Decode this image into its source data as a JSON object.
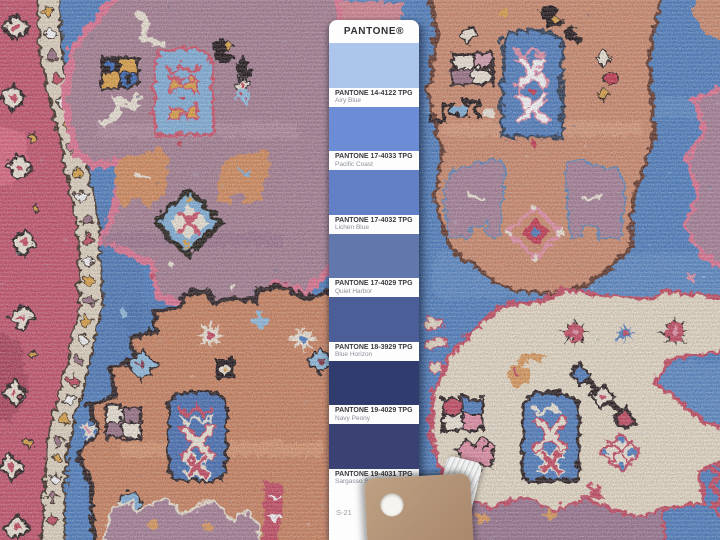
{
  "pantone_card": {
    "brand": "PANTONE®",
    "swatches": [
      {
        "code": "PANTONE 14-4122 TPG",
        "name": "Airy Blue",
        "hex": "#ACC5EA"
      },
      {
        "code": "PANTONE 17-4033 TPG",
        "name": "Pacific Coast",
        "hex": "#6C8DD6"
      },
      {
        "code": "PANTONE 17-4032 TPG",
        "name": "Lichen Blue",
        "hex": "#6380C6"
      },
      {
        "code": "PANTONE 17-4029 TPG",
        "name": "Quiet Harbor",
        "hex": "#6277AB"
      },
      {
        "code": "PANTONE 18-3929 TPG",
        "name": "Blue Horizon",
        "hex": "#4C5E97"
      },
      {
        "code": "PANTONE 19-4029 TPG",
        "name": "Navy Peony",
        "hex": "#313C6E"
      },
      {
        "code": "PANTONE 19-4031 TPG",
        "name": "Sargasso Sea",
        "hex": "#3A4273"
      }
    ],
    "footer_code": "S-21"
  },
  "rug_palette": {
    "field_blue": "#4a7ec2",
    "border_red": "#c94f68",
    "gold": "#e2a33c",
    "mauve": "#a77e91",
    "pink_outline": "#e4718f",
    "salmon": "#d28a68",
    "orange": "#d0825a",
    "cream": "#ece0c8",
    "dark_brown": "#241812",
    "light_blue": "#7fb2dc",
    "navy_panel": "#3f6db4",
    "crimson": "#c8445c",
    "plum": "#9b6f83",
    "ivory": "#f3ead8"
  }
}
